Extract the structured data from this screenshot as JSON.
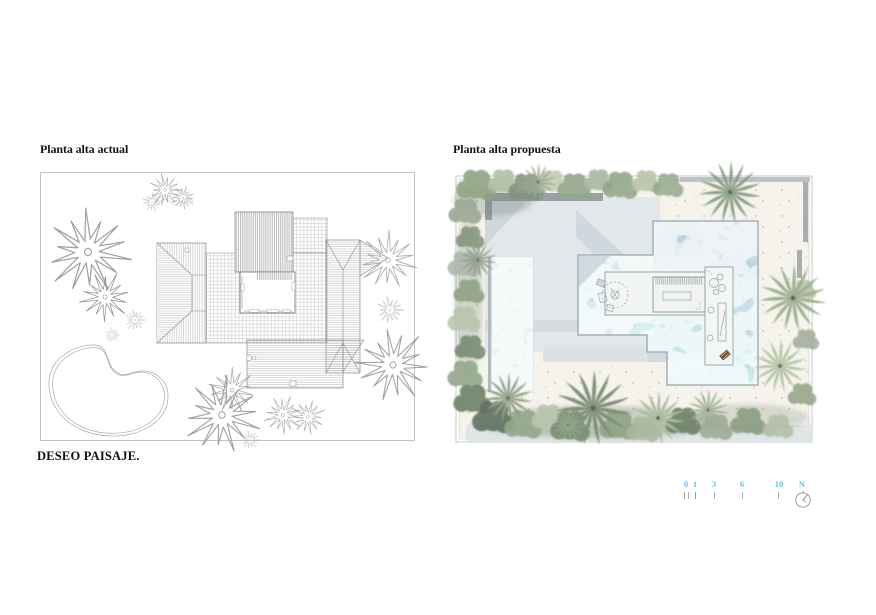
{
  "document": {
    "background": "#ffffff",
    "type_note": "architecture presentation sheet, two floor plans side by side"
  },
  "panels": {
    "left": {
      "title": "Planta alta actual"
    },
    "right": {
      "title": "Planta alta propuesta"
    }
  },
  "footer": {
    "brand": "DESEO PAISAJE."
  },
  "scale_bar": {
    "labels": [
      "0",
      "1",
      "3",
      "6",
      "10"
    ],
    "north_label": "N"
  },
  "palette": {
    "scale_number": "#5ec1ef",
    "tick_gray": "#b3b3b3",
    "linework_gray": "#9a9a9a",
    "water_deep": "#8fb6c6",
    "water_shallow": "#a9dcde",
    "lap_pool": "#ebf4f4",
    "sand": "#f6f3ec",
    "sand_speckle": "#c77d52",
    "terrace": "#e2e7ea",
    "wall_dark": "#9aa1a5",
    "vegetation_green": "#93a88c",
    "vegetation_dark": "#5f7260"
  }
}
